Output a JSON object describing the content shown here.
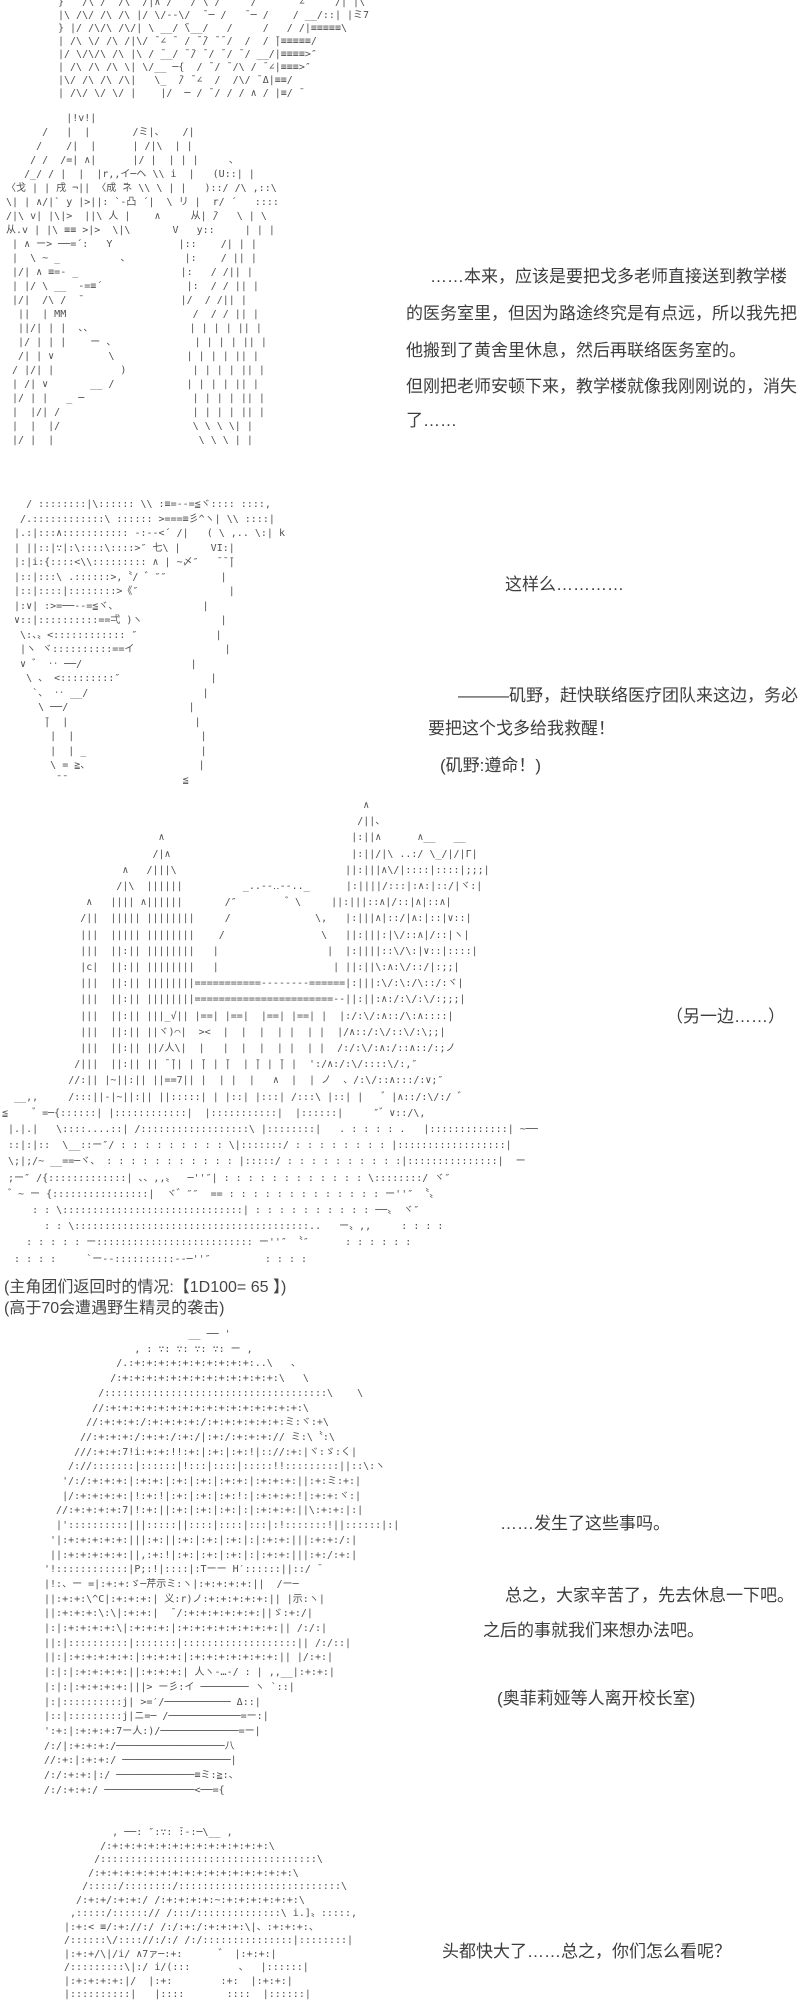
{
  "page": {
    "background": "#ffffff",
    "dialogue_color": "#3d3d3d",
    "aa_color": "#4f4f4f"
  },
  "aa": {
    "top_banner": {
      "lines": [
        "}   /\\ /  /\\  /|∧ /   / ̄\\ /     /       ∠ ̄ ̄   /| |\\",
        "|\\ /\\/ /\\ /\\ |/ \\/--\\/  ̄ ─ /   ̄ ─ /    / __/::| |ミ7",
        "} |/ /\\/\\ /\\/| \\ __/ ̄\\__/   /     /   / /|≡≡≡≡≡\\",
        "| /\\ \\/ /\\ /|\\/ ̄ ∠ ̄  / ̄ ̄/ ̄ ̄ /  /  / ̄|≡≡≡≡≡/",
        "|/ \\/\\/\\ /\\ |\\ / ̄__/ ̄ ̄/ ̄ / ̄ / ̄ / __/|≡≡≡≡>″",
        "| /\\ /\\ /\\ \\| \\/__ ─{  / ̄ / ̄ /\\ / ̄ ∠|≡≡≡>″",
        "|\\/ /\\ /\\ /\\|   \\_  ̄/ ̄ ∠  /  /\\/ ̄ Δ|≡≡/",
        "| /\\/ \\/ \\/ |    |/  ─ / ̄ / / / ∧ / |≡/ ̄"
      ]
    },
    "character_1": {
      "lines": [
        "           |!v!|",
        "       /   |  |       /ミ|、   /|",
        "      /    /|  |      | /|\\  | |",
        "     / /  /=| ∧|      |/ |  | | |     、",
        "    /_/ / |  |  |r,,イ─ヘ \\\\ i  |   (U::| |",
        " 〈戈 | | 戌 ¬|| 〈成 ̄ネ \\\\ \\ | |   )::/ /\\ ,::\\",
        " \\| | ∧/|` y |>||: `-凸 ´|  \\ リ |  r/ ´   ::::",
        " /|\\ v| |\\|>  ||\\ 人 |    ∧     从| ̄/   \\ | \\",
        " 从.v | |\\ ≡≡ >|>  \\|\\       V   y::     | | |",
        "  | ∧ ー> ──=´:   Y           |::    /| | |",
        "  |  \\ ~ _          、         |:    / || |",
        "  |/| ∧ ≡=- _                 |:   / /|| |",
        "  | |/ \\ __  -=≡´              |:  / / || |",
        "  |/|  /\\ /  ̄                 |/  / /|| |",
        "   ||  | MM                     /  / / || |",
        "   ||/| | |  、、                | | | | || |",
        "   |/ | | |    ー 、             | | | | || |",
        "   /| | ∨         \\            | | | | || |",
        "  / |/| |           )           | | | | || |",
        "  | /| ∨       __ /            | | | | || |",
        "  |/ | |   _ ─                  | | | | || |",
        "  |  |/| /                      | | | | || |",
        "  |  |  |/                      \\ \\ \\ \\| |",
        "  |/ |  |                        \\ \\ \\ | |"
      ]
    },
    "character_2": {
      "lines": [
        "    / ::::::::|\\:::::: \\\\ :≡=--=≦ヾ:::: ::::,",
        "   /.::::::::::::\\ :::::: >===≡彡^ヽ| \\\\ ::::|",
        "  |.:|:::∧::::::::::: -:--<´ /|   ( \\ ,.. \\:| k",
        "  | ||::|∵|:\\::::\\::::>″ 七\\ |     VI:|",
        "  |:|i:{::::<\\\\::::::::: ∧ | ~〆″   ̄ ̄ ̄|",
        "  |::|:::\\ .::::::>,〝/ ゛″″         |",
        "  |::|::::|::::::::>《″               |",
        "  |:∨| :>=──--=≦ヾ、              |",
        "  ∨::|::::::::::==弌 )ヽ             |",
        "   \\:、〟<:::::::::::: ″             |",
        "   |ヽ ヾ::::::::::==イ               |",
        "   ∨ ゛ ‥ ──/                  |",
        "    \\ 、 <:::::::::″               |",
        "     `、 ‥ __/                   |",
        "      \\ ──/                    |",
        "       ̄|  |                     |",
        "        |  |                     |",
        "        |  | _                   |",
        "        \\ = ≧、                  |",
        "         ̄ ̄                    ≦"
      ]
    },
    "castle": {
      "lines": [
        "                                                            ∧",
        "                                                           /||、",
        "                          ∧                               |:||∧      ∧__   __",
        "                         /|∧                              |:||/|\\ ..:/ \\_/|/|Γ|",
        "                    ∧   /|||\\                            ||:|||∧\\/|::::|::::|;;;|",
        "                   /|\\  ||||||          _..--‥--.._      |:||||/:::|:∧:|::/|ヾ:|",
        "              ∧   |||| ∧||||||       /″        ゛\\     ||:|||::∧|/::|∧|::∧|",
        "             /||  ||||| ||||||||     /              \\,   |:|||∧|::/|∧:|::|∨::|",
        "             |||  ||||| ||||||||    /                \\   ||:|||:|\\/::∧|/::|ヽ|",
        "             |||  ||:|| ||||||||   |                  |  |:||||::\\/\\:|∨::|::::|",
        "             |c|  ||:|| ||||||||   |                   | ||:||\\:∧:\\/::/|:;;|",
        "             |||  ||:|| ||||||||===========--------======|:|||:\\/:\\:/\\::/:ヾ|",
        "             |||  ||:|| ||||||||=======================--||:||:∧:/:\\/:\\/:;;;|",
        "             |||  ||:|| |||_√|| |==| |==|  |==| |==| |  |:/:\\/:∧::/\\:∧::::|",
        "             |||  ||:|| ||ヾ)⌒|  ><  |  |  |  | |  | |  |/∧::/:\\/::\\/:\\;;|",
        "             |||  ||:|| ||/人\\|  |   |  |  |  | |  | |  /:/:\\/:∧:/::∧::/:;ノ",
        "            /|||  ||:|| || ̄ ̄|| | ̄| | ̄|  | ̄| | ̄| |  ':/∧:/:\\/::::\\/:,″",
        "           //:|| |~||:|| ||==7|| |  | |  |   ∧  |  | ノ  、/:\\/::∧:::/:∨;″",
        "  __,,     /:::||-|~||:|| ||:::::| | |::| |:::| /:::\\ |::| |   ゛|∧::/:\\/:/ ゛",
        "≦    ゛=─{::::::| |::::::::::::|  |:::::::::::|  |::::::|     ″゛∨::/\\,",
        " |.|.|   \\::::....::| /::::::::::::::::::\\ |::::::::|   . : : : : .   |:::::::::::::| ~──",
        " ::|:|::  \\__::ー″/ : : : : : : : : : \\|:::::::/ : : : : : : : : |::::::::::::::::::|",
        " \\;|;/~ __==─ヾ、 : : : : : : : : : : : |:::::/ : : : : : : : : : :|:::::::::::::::|  ー",
        " ;ー″ /{:::::::::::::| 、、,,〟  ─''″| : : : : : : : : : : : : \\::::::::/ ヾ″",
        " ゛~ ー {::::::::::::::::|  ヾ゛″″  == : : : : : : : : : : : : : ー''″ 〝〟",
        "     : : \\::::::::::::::::::::::::::::::| : : : : : : : : : : ──〟 ヾ″",
        "       : : \\:::::::::::::::::::::::::::::::::::::::..   ー〟,,     : : : :",
        "    : : : : : ー:::::::::::::::::::::::::: ー''″ 〝″      : : : : : :",
        "  : : : :     `ー--::::::::::--─''″         : : : :"
      ]
    },
    "character_3": {
      "lines": [
        "                         __ ── '",
        "                , : ∵: ∵: ∵: ∵: ー ,",
        "             /.:+:+:+:+:+:+:+:+:+:+:..\\   、",
        "            /:+:+:+:+:+:+:+:+:+:+:+:+:+:\\   \\",
        "          /:::::::::::::::::::::::::::::::::::::\\    \\",
        "         //:+:+:+:+:+:+:+:+:+:+:+:+:+:+:+:+:\\",
        "        //:+:+:+:/:+:+:+:+:/:+:+:+:+:+:+:ミ:ヾ:+\\",
        "       //:+:+:+:/:+:+:/:+:/|:+:/:+:+:+:// ミ:\\〝:\\",
        "      ///:+:+:7!i:+:+:!!:+:|:+:|:+:!|:://:+:|ヾ:ゞ:く|",
        "     /://:::::::|::::::|!:::|::::|:::::!!:::::::::||::\\:ヽ",
        "    '/:/:+:+:+:|:+:+:|:+:|:+:|:+:+:|:+:+:+:||:+:ミ:+:|",
        "    |/:+:+:+:+:|!:+:!|:+:|:+:|:+:!:|:+:+:+:!|:+:+:ヾ:|",
        "   //:+:+:+:+:7|!:+:||:+:|:+:|:+:|:|:+:+:+:||\\:+:+:|:|",
        "   |'::::::::::|||:::::||::::|::::|:::|:!:::::::!||::::::|:|",
        "  '|:+:+:+:+:+:|||:+:||:+:|:+:|:+:|:|:+:+:|||:+:+:/:|",
        "  ||:+:+:+:+:+:||,:+:!|:+:|:+:|:+:|:|:+:+:|||:+:/:+:|",
        " '!::::::::::::|P;:!|::::|:Tーー H′::::::||::/ ̄",
        " |!:、ー =|:+:+:ゞ─芹示ミ:ヽ|:+:+:+:+:||  /ー─",
        " ||:+:+:\\^C|:+:+:+:| 义:r)ノ:+:+:+:+:+:|| |示:ヽ|",
        " ||:+:+:+:\\:\\|:+:+:|  ̄ /:+:+:+:+:+:+:||ゞ:+:/|",
        " |:|:+:+:+:+:\\|:+:+:+:|:+:+:+:+:+:+:+:+:|| /:/:|",
        " ||:|::::::::::|:::::::|:::::::::::::::::::|| /:/::|",
        " ||:|:+:+:+:+:+:|:+:+:+:|:+:+:+:+:+:+:+:|| |/:+:|",
        " |:|:|:+:+:+:+:||:+:+:+:| 人ヽ-…-/ : | ,,__|:+:+:|",
        " |:|:|:+:+:+:+:|||> ー彡:イ ──────── ヽ `::|",
        " |:|::::::::::j| >=′/─────────── Δ::|",
        " |::|:::::::::j|ニ=─ /────────────=ー:|",
        " ':+:|:+:+:+:7ー人:)/─────────────=ー|",
        " /:/|:+:+:+:/──────────────────八",
        " //:+:|:+:+:/ ──────────────────|",
        " /:/:+:+:|:/ ─────────────≡ミ:≧:、",
        " /:/:+:+:/ ───────────────<──={"
      ]
    },
    "character_4": {
      "lines": [
        "         , ──: ″:∵: ̄:‐:─\\__ ,",
        "       /:+:+:+:+:+:+:+:+:+:+:+:+:+:\\",
        "      /::::::::::::::::::::::::::::::::::::\\",
        "     /:+:+:+:+:+:+:+:+:+:+:+:+:+:+:+:+:\\",
        "    /:::::/::::::::/:::::::::::::::::::::::::::\\",
        "   /:+:+/:+:+:/ /:+:+:+:+:~:+:+:+:+:+:+:\\",
        "  ,:::::/::::::// /:::/::::::::::::::\\ i.]〟:::::,",
        " |:+:< ≡/:+://:/ /:/:+:/:+:+:+:\\|、:+:+:+:、",
        " /::::::\\/:::://:/:/ /:/:::::::::::::::|::::::::|",
        " |:+:+/\\|/i/ ∧7ァ─:+:      ゛ |:+:+:|",
        " /:::::::::\\|:/ i/(:::        、  |::::::|",
        " |:+:+:+:+:|/  |:+:        :+:  |:+:+:|",
        " |::::::::::|   |::::       ::::  |::::::|"
      ]
    }
  },
  "text": {
    "monologue": [
      "……本来，应该是要把戈多老师直接送到教学楼",
      "的医务室里，但因为路途终究是有点远，所以我先把",
      "他搬到了黄舍里休息，然后再联络医务室的。",
      "但刚把老师安顿下来，教学楼就像我刚刚说的，消失",
      "了……"
    ],
    "response": "这样么…………",
    "command": [
      "———矶野，赶快联络医疗团队来这边，务必",
      "要把这个戈多给我救醒！"
    ],
    "command_ack": "(矶野:遵命！)",
    "scene_aside": "（另一边……）",
    "dice_info": "(主角团们返回时的情况:【1D100= 65 】)",
    "dice_note": "(高于70会遭遇野生精灵的袭击)",
    "reaction": "……发生了这些事吗。",
    "closing": [
      "总之，大家辛苦了，先去休息一下吧。",
      "之后的事就我们来想办法吧。"
    ],
    "stage_note": "(奥菲莉娅等人离开校长室)",
    "final_line": "头都快大了……总之，你们怎么看呢？"
  }
}
